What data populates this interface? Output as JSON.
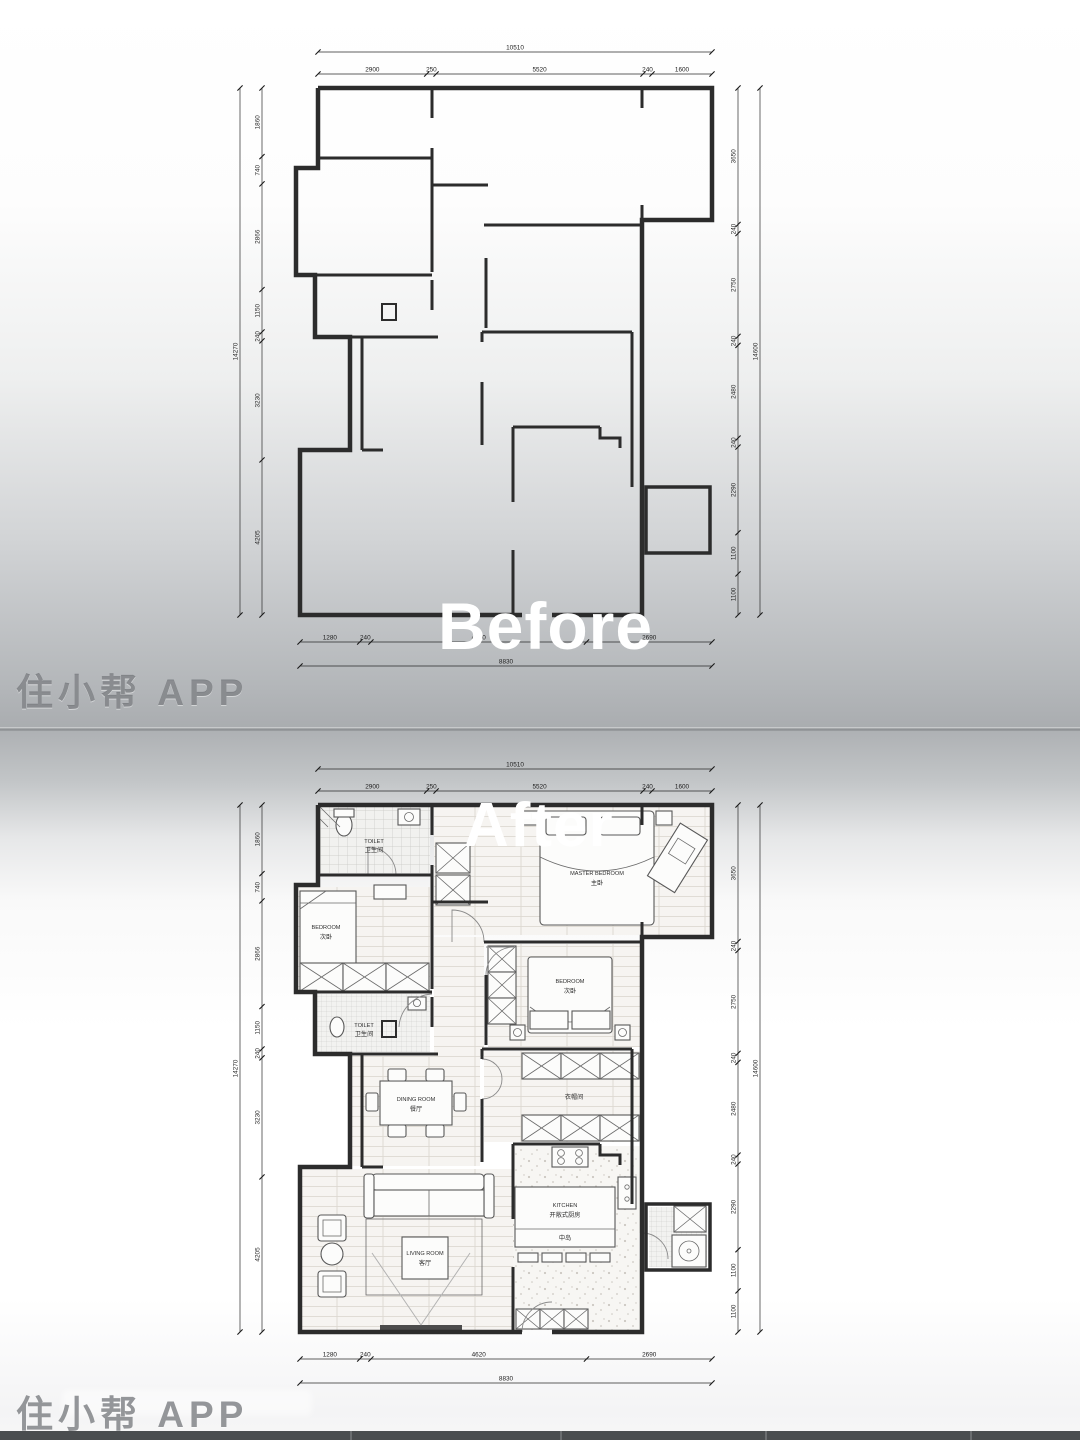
{
  "overlays": {
    "before": "Before",
    "after": "After"
  },
  "watermarks": {
    "top": "住小帮 APP",
    "bottom": "住小帮 APP"
  },
  "before_plan": {
    "dims": {
      "top": {
        "total": "10510",
        "segments": [
          "2900",
          "250",
          "5520",
          "240",
          "1600"
        ]
      },
      "left": {
        "total": "14270",
        "segments": [
          "1860",
          "740",
          "2866",
          "1150",
          "240",
          "3230",
          "4205"
        ]
      },
      "right": {
        "total": "14600",
        "segments": [
          "3650",
          "240",
          "2750",
          "240",
          "2480",
          "240",
          "2290",
          "1100",
          "1100"
        ]
      },
      "bottom": {
        "total": "8830",
        "segments": [
          "1280",
          "240",
          "4620",
          "2690"
        ]
      }
    }
  },
  "after_plan": {
    "dims": {
      "top": {
        "total": "10510",
        "segments": [
          "2900",
          "250",
          "5520",
          "240",
          "1600"
        ]
      },
      "left": {
        "total": "14270",
        "segments": [
          "1860",
          "740",
          "2866",
          "1150",
          "240",
          "3230",
          "4205"
        ]
      },
      "right": {
        "total": "14600",
        "segments": [
          "3650",
          "240",
          "2750",
          "240",
          "2480",
          "240",
          "2290",
          "1100",
          "1100"
        ]
      },
      "bottom": {
        "total": "8830",
        "segments": [
          "1280",
          "240",
          "4620",
          "2690"
        ]
      }
    },
    "rooms": {
      "toilet_main": {
        "en": "TOILET",
        "zh": "卫生间"
      },
      "master": {
        "en": "MASTER BEDROOM",
        "zh": "主卧"
      },
      "bedroom_left": {
        "en": "BEDROOM",
        "zh": "次卧"
      },
      "toilet_small": {
        "en": "TOILET",
        "zh": "卫生间"
      },
      "bedroom_mid": {
        "en": "BEDROOM",
        "zh": "次卧"
      },
      "cloakroom": {
        "zh": "衣帽间"
      },
      "dining": {
        "en": "DINING ROOM",
        "zh": "餐厅"
      },
      "kitchen": {
        "en": "KITCHEN",
        "zh": "开敞式厨房"
      },
      "island": {
        "zh": "中岛"
      },
      "living": {
        "en": "LIVING ROOM",
        "zh": "客厅"
      }
    }
  }
}
